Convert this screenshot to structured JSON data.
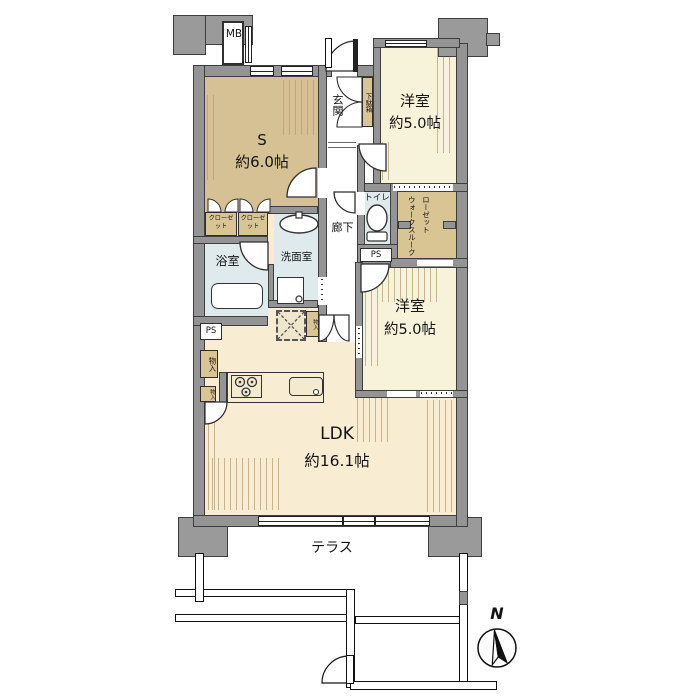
{
  "colors": {
    "wall_gray": "#949494",
    "closet_tan": "#d9c493",
    "bedroom_cream": "#f6f3da",
    "ldk_cream": "#f8ecd2",
    "wet_area_blue": "#dfeaed",
    "hatch_stroke": "#b49a6e"
  },
  "rooms": {
    "service_room": {
      "name": "S",
      "size": "約6.0帖"
    },
    "bedroom_top": {
      "name": "洋室",
      "size": "約5.0帖"
    },
    "bedroom_mid": {
      "name": "洋室",
      "size": "約5.0帖"
    },
    "ldk": {
      "name": "LDK",
      "size": "約16.1帖"
    },
    "entrance_label": "玄関",
    "corridor_label": "廊下",
    "bathroom_label": "浴室",
    "washroom_label": "洗面室",
    "toilet_label": "トイレ",
    "terrace_label": "テラス",
    "walk_through_closet_label": "ウォークスルークローゼット",
    "shoe_cabinet_label": "下駄箱",
    "meter_box_label": "MB",
    "closet_label_1": "クローゼット",
    "closet_label_2": "クローゼット",
    "storage_label_1": "物入",
    "storage_label_2": "物入",
    "storage_label_3": "物入",
    "pipe_space_label_1": "PS",
    "pipe_space_label_2": "PS"
  },
  "compass": {
    "north_label": "N"
  }
}
